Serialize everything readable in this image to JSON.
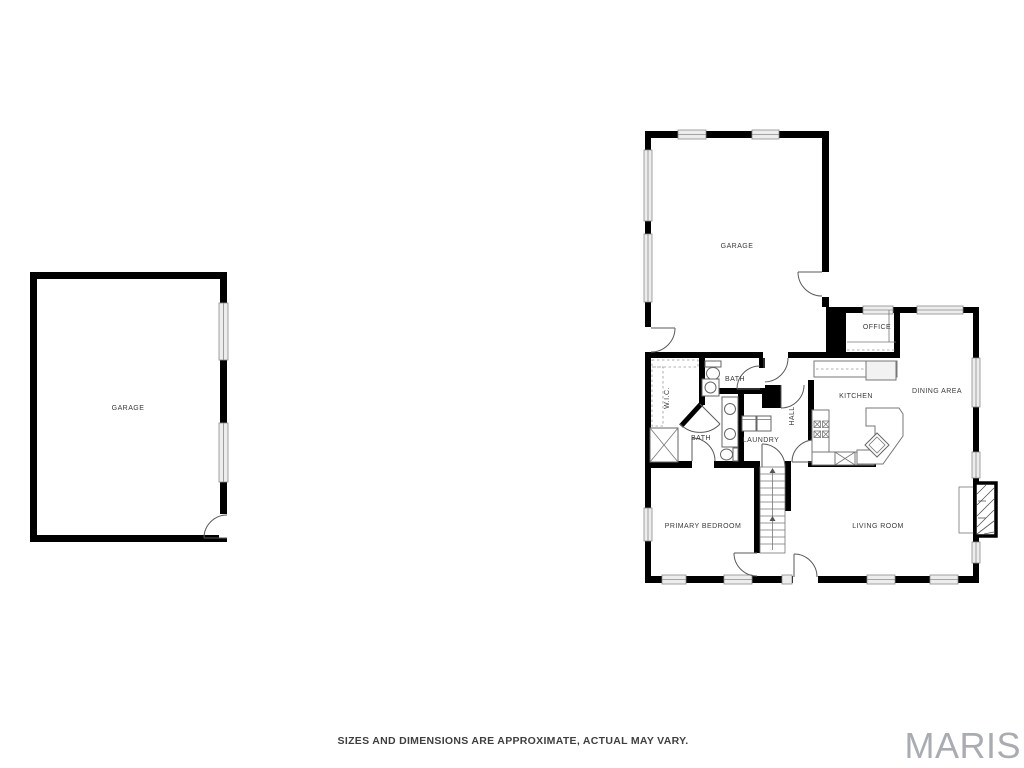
{
  "canvas": {
    "background": "#ffffff",
    "wall_color": "#000000",
    "window_fill": "#ededed",
    "label_color": "#3a3a3a",
    "watermark_color": "#a9acb1"
  },
  "detached_garage": {
    "label": "GARAGE"
  },
  "main_floor": {
    "garage": "GARAGE",
    "office": "OFFICE",
    "dining_area": "DINING AREA",
    "kitchen": "KITCHEN",
    "wic": "W.I.C.",
    "bath_upper": "BATH",
    "bath_lower": "BATH",
    "hall": "HALL",
    "laundry": "LAUNDRY",
    "primary_bedroom": "PRIMARY BEDROOM",
    "living_room": "LIVING ROOM"
  },
  "footer": {
    "disclaimer": "SIZES AND DIMENSIONS ARE APPROXIMATE, ACTUAL MAY VARY."
  },
  "watermark": {
    "brand": "MARIS"
  }
}
